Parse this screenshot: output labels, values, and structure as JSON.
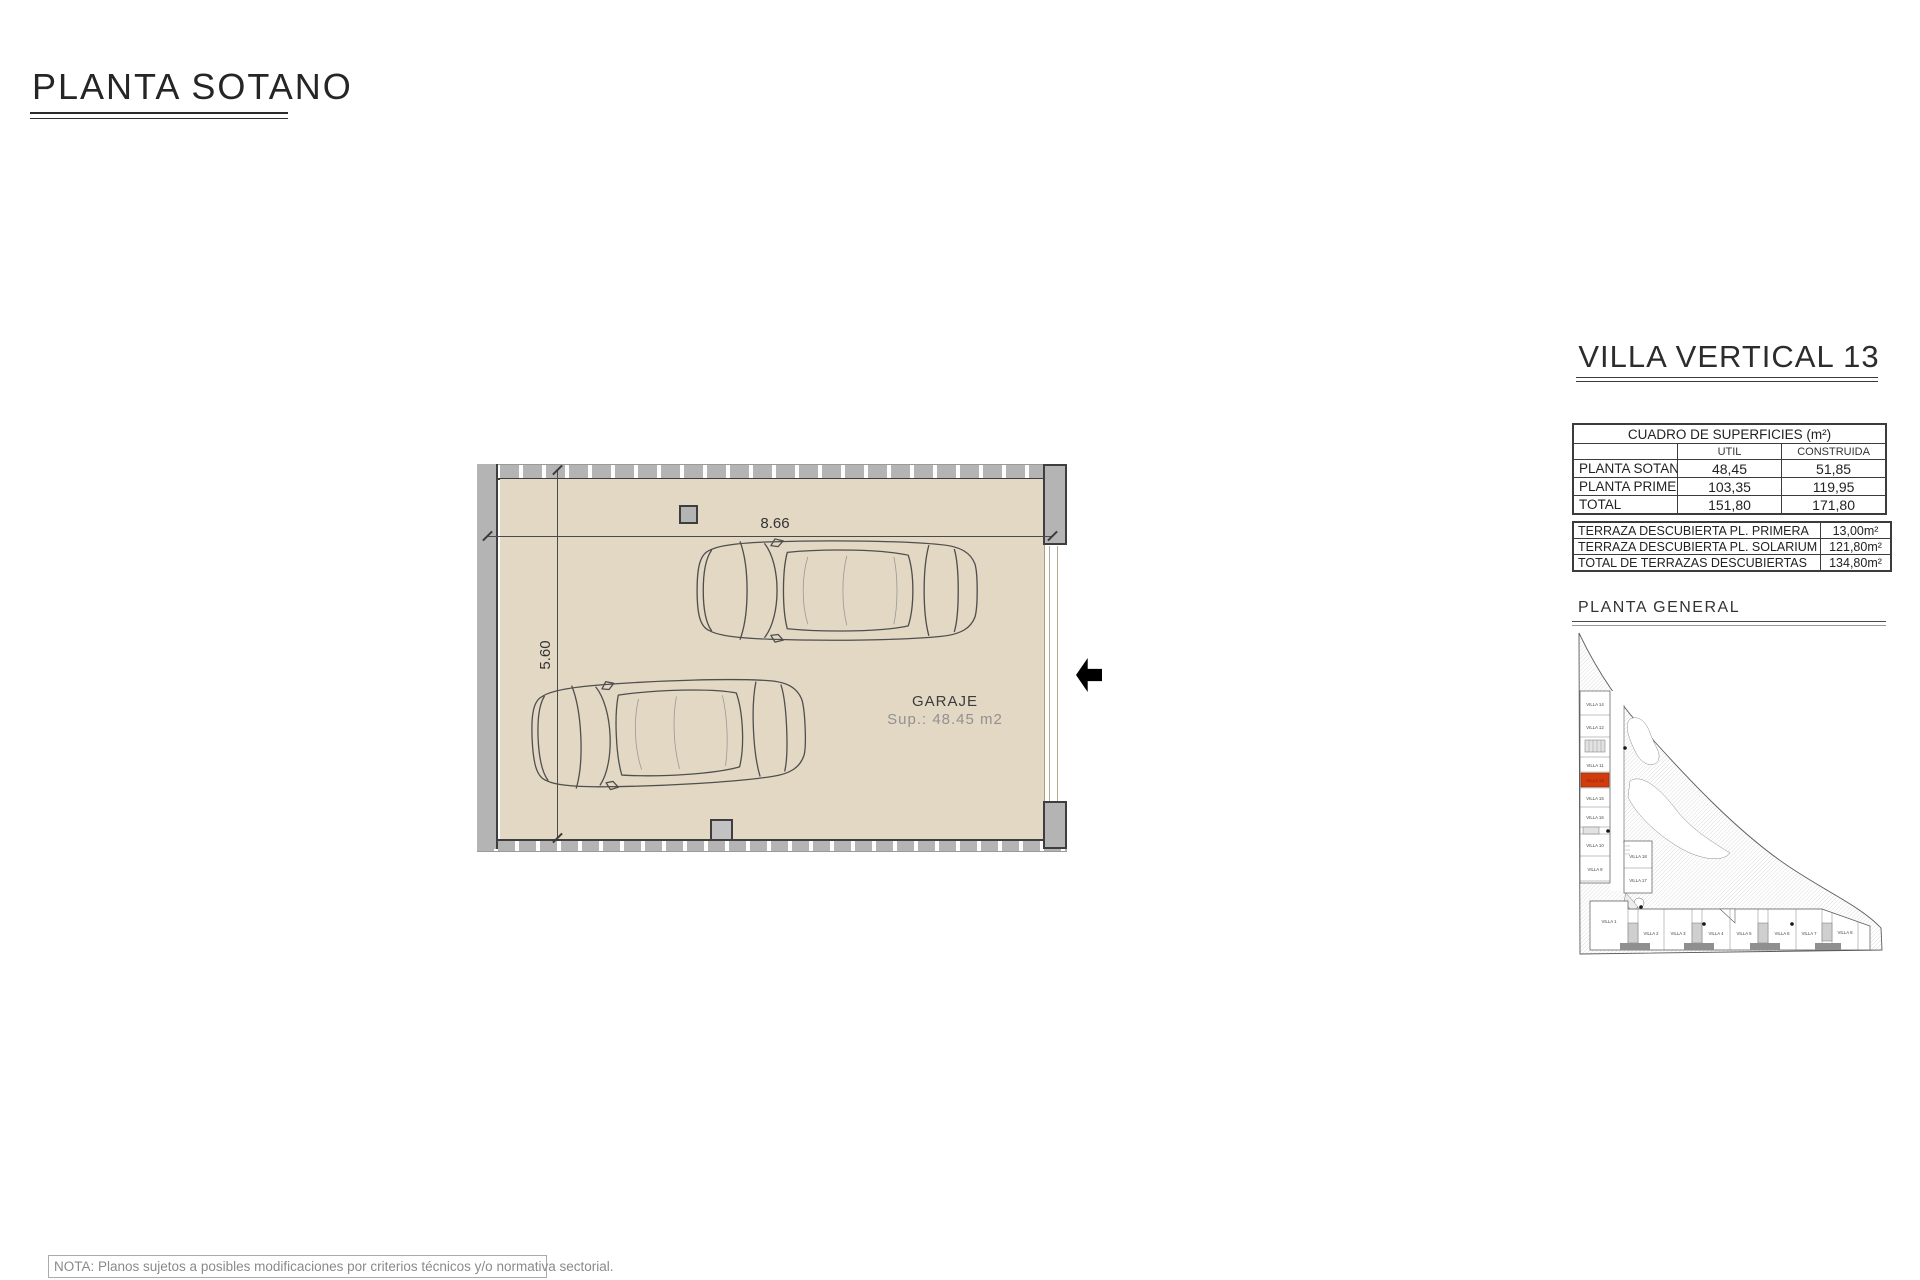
{
  "page": {
    "title": "PLANTA SOTANO",
    "note": "NOTA: Planos sujetos a posibles modificaciones por criterios técnicos y/o normativa sectorial."
  },
  "plan": {
    "room_label": "GARAJE",
    "room_area": "Sup.: 48.45 m2",
    "dim_width": "8.66",
    "dim_height": "5.60"
  },
  "panel": {
    "title": "VILLA VERTICAL 13",
    "surfaces_table": {
      "title": "CUADRO DE SUPERFICIES (m²)",
      "columns": [
        "",
        "UTIL",
        "CONSTRUIDA"
      ],
      "rows": [
        {
          "label": "PLANTA SOTANO",
          "util": "48,45",
          "construida": "51,85"
        },
        {
          "label": "PLANTA PRIMERA",
          "util": "103,35",
          "construida": "119,95"
        },
        {
          "label": "TOTAL",
          "util": "151,80",
          "construida": "171,80"
        }
      ]
    },
    "terraces_table": {
      "rows": [
        {
          "label": "TERRAZA DESCUBIERTA PL. PRIMERA",
          "value": "13,00m²"
        },
        {
          "label": "TERRAZA DESCUBIERTA PL. SOLARIUM",
          "value": "121,80m²"
        },
        {
          "label": "TOTAL DE TERRAZAS DESCUBIERTAS",
          "value": "134,80m²"
        }
      ]
    },
    "site_plan": {
      "title": "PLANTA  GENERAL",
      "highlighted_villa": "VILLA 13",
      "left_villas": [
        "VILLA 14",
        "VILLA 12",
        "VILLA 11",
        "VILLA 13",
        "VILLA 15",
        "VILLA 16",
        "VILLA 10",
        "VILLA 9"
      ],
      "middle_villas": [
        "VILLA 18",
        "VILLA 17"
      ],
      "bottom_villas": [
        "VILLA 1",
        "VILLA 2",
        "VILLA 3",
        "VILLA 4",
        "VILLA 5",
        "VILLA 6",
        "VILLA 7",
        "VILLA 8"
      ]
    }
  },
  "colors": {
    "floor_beige": "#e3d8c4",
    "wall_gray": "#b4b4b4",
    "line_dark": "#3e3e3e",
    "highlight_red": "#d23b0d"
  }
}
